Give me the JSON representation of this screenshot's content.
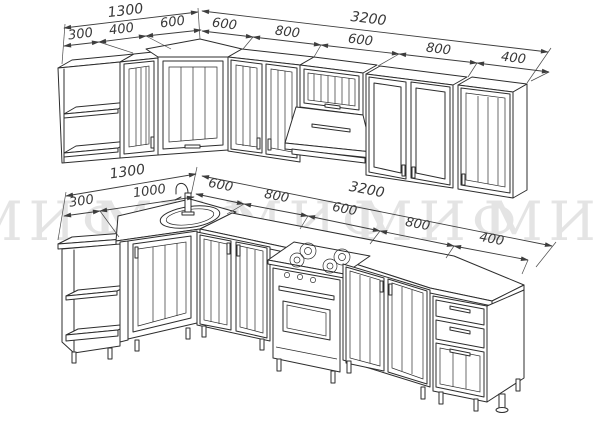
{
  "page": {
    "description": "Kitchen set technical perspective drawing",
    "background": "#ffffff"
  },
  "watermark": {
    "text": "МИФ",
    "color": "#e4e4e4",
    "visible_repeats": 5
  },
  "style": {
    "line_color": "#2d2d2d",
    "dimension_color": "#3d3d3d"
  },
  "dims": {
    "upper_row": {
      "left_total": "1300",
      "left_segments": [
        "300",
        "400",
        "600"
      ],
      "right_total": "3200",
      "right_segments": [
        "600",
        "800",
        "600",
        "800",
        "400"
      ]
    },
    "base_row": {
      "left_total": "1300",
      "left_segments": [
        "300",
        "1000"
      ],
      "right_total": "3200",
      "right_segments": [
        "600",
        "800",
        "600",
        "800",
        "400"
      ]
    }
  }
}
